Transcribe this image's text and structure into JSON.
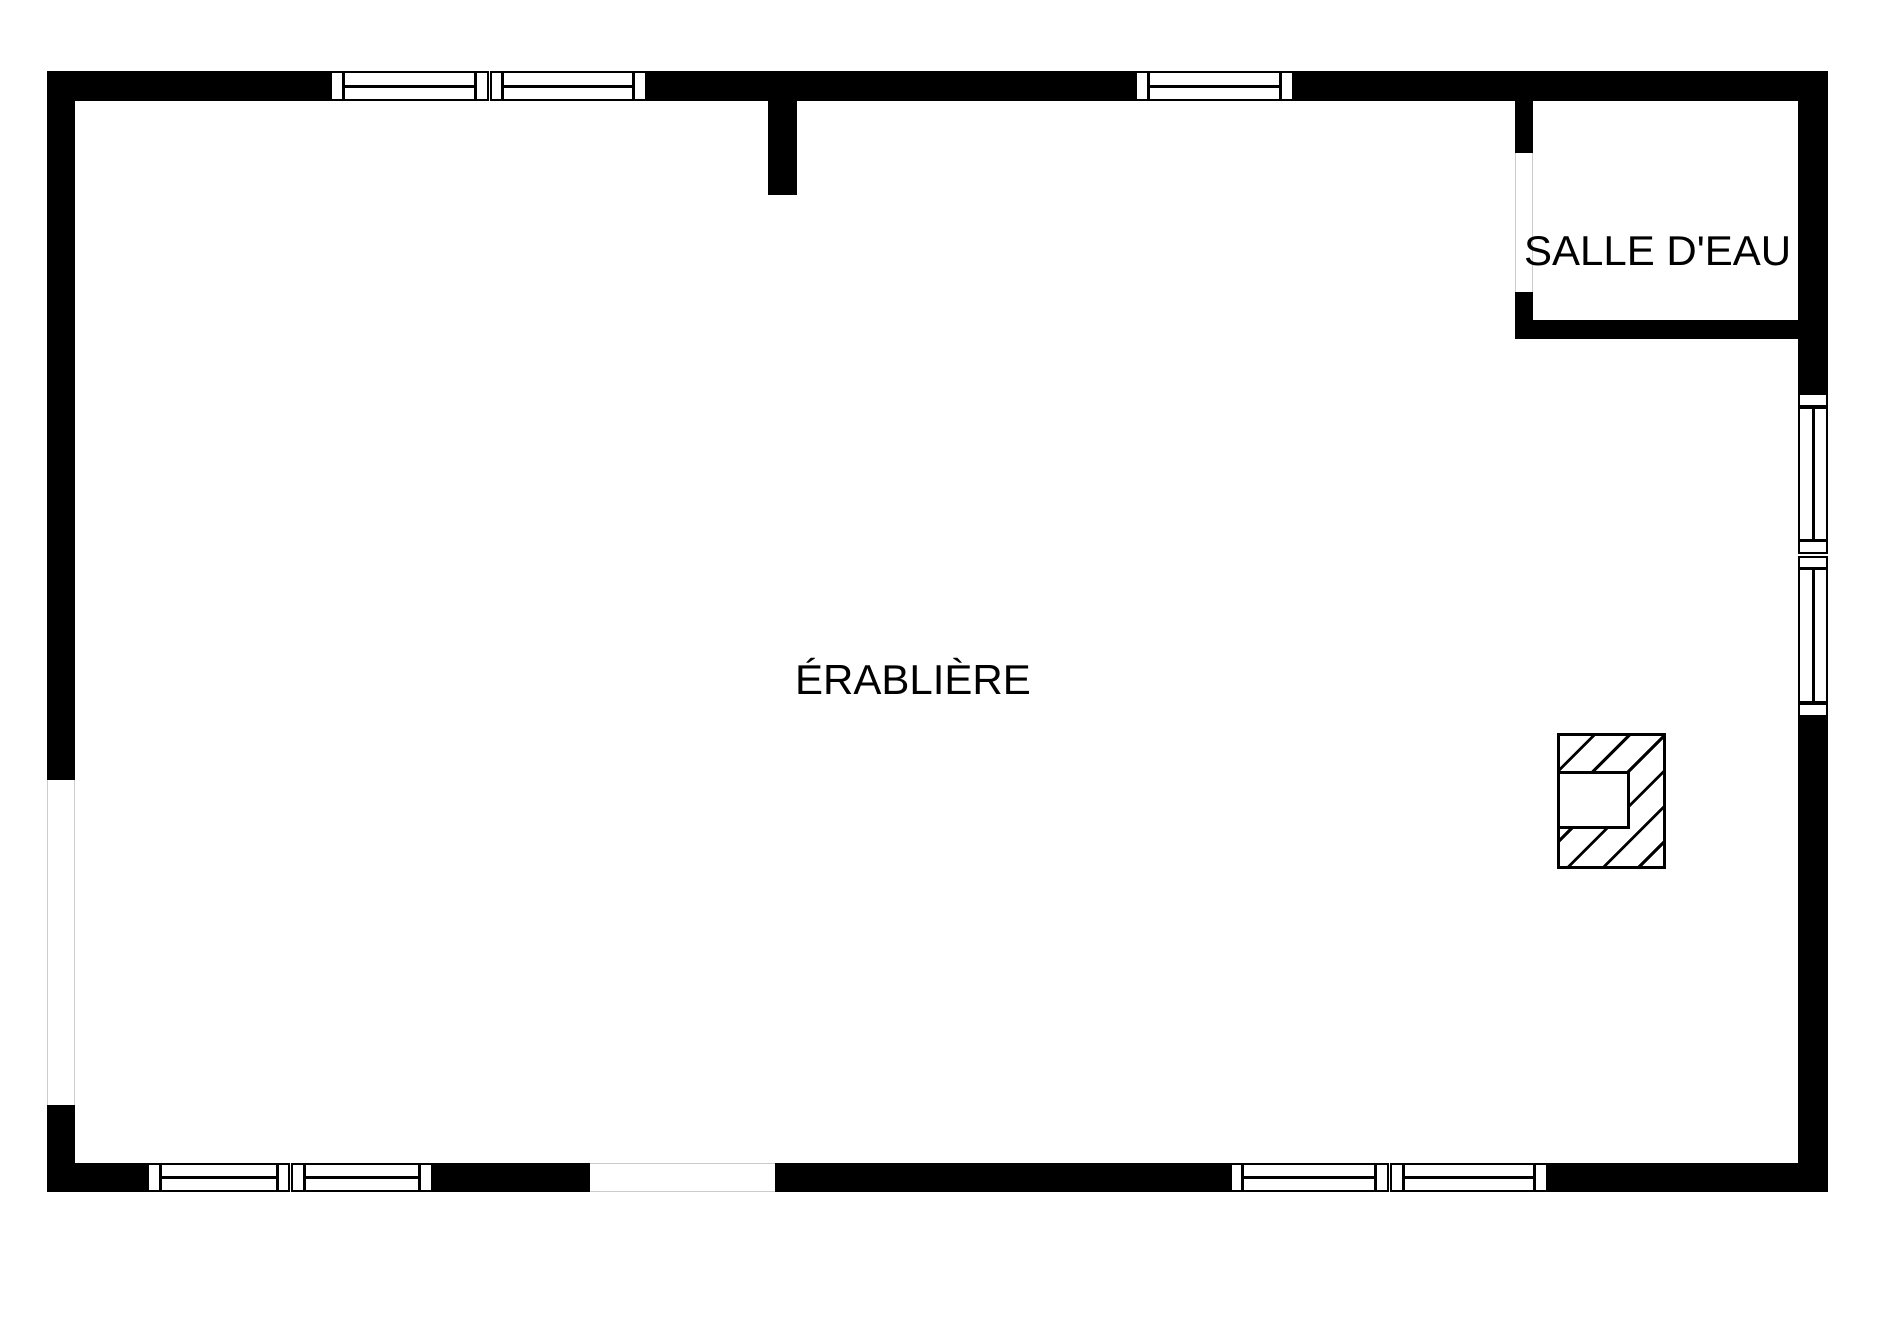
{
  "floor_plan": {
    "rooms": [
      {
        "id": "main-room",
        "label": "ÉRABLIÈRE"
      },
      {
        "id": "bathroom",
        "label": "SALLE D'EAU"
      }
    ],
    "colors": {
      "wall": "#000000",
      "background": "#ffffff",
      "opening_outline": "#cccccc"
    }
  }
}
